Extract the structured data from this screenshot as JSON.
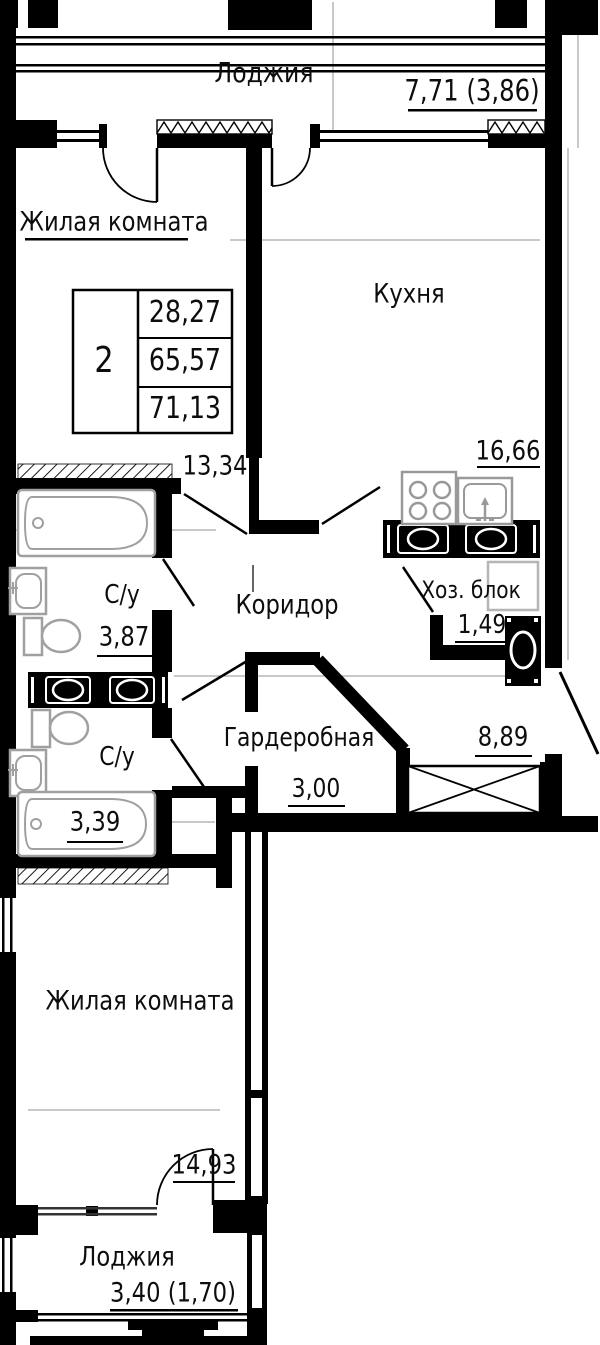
{
  "title": "План квартиры (2-комнатная)",
  "rooms": {
    "loggia_top": {
      "label": "Лоджия",
      "area": "7,71 (3,86)"
    },
    "living_top": {
      "label": "Жилая комната",
      "area": "13,34"
    },
    "kitchen": {
      "label": "Кухня",
      "area": "16,66"
    },
    "corridor": {
      "label": "Коридор",
      "area": "8,89"
    },
    "bathroom_top": {
      "label": "С/у",
      "area": "3,87"
    },
    "bathroom_bottom": {
      "label": "С/у",
      "area": "3,39"
    },
    "utility": {
      "label": "Хоз. блок",
      "area": "1,49"
    },
    "wardrobe": {
      "label": "Гардеробная",
      "area": "3,00"
    },
    "living_bottom": {
      "label": "Жилая комната",
      "area": "14,93"
    },
    "loggia_bottom": {
      "label": "Лоджия",
      "area": "3,40 (1,70)"
    }
  },
  "stamp": {
    "rooms_count": "2",
    "living_area": "28,27",
    "floor_area": "65,57",
    "total_area": "71,13"
  },
  "icons": [
    "bathtub-icon",
    "sink-icon",
    "toilet-icon",
    "stove-icon",
    "kitchen-sink-icon",
    "washing-machine-icon",
    "vent-block-icon",
    "shaft-x-icon",
    "door-swing-icon"
  ],
  "colors": {
    "wall": "#000000",
    "fixture": "#a0a0a0",
    "thin_line": "#909090",
    "background": "#ffffff"
  }
}
